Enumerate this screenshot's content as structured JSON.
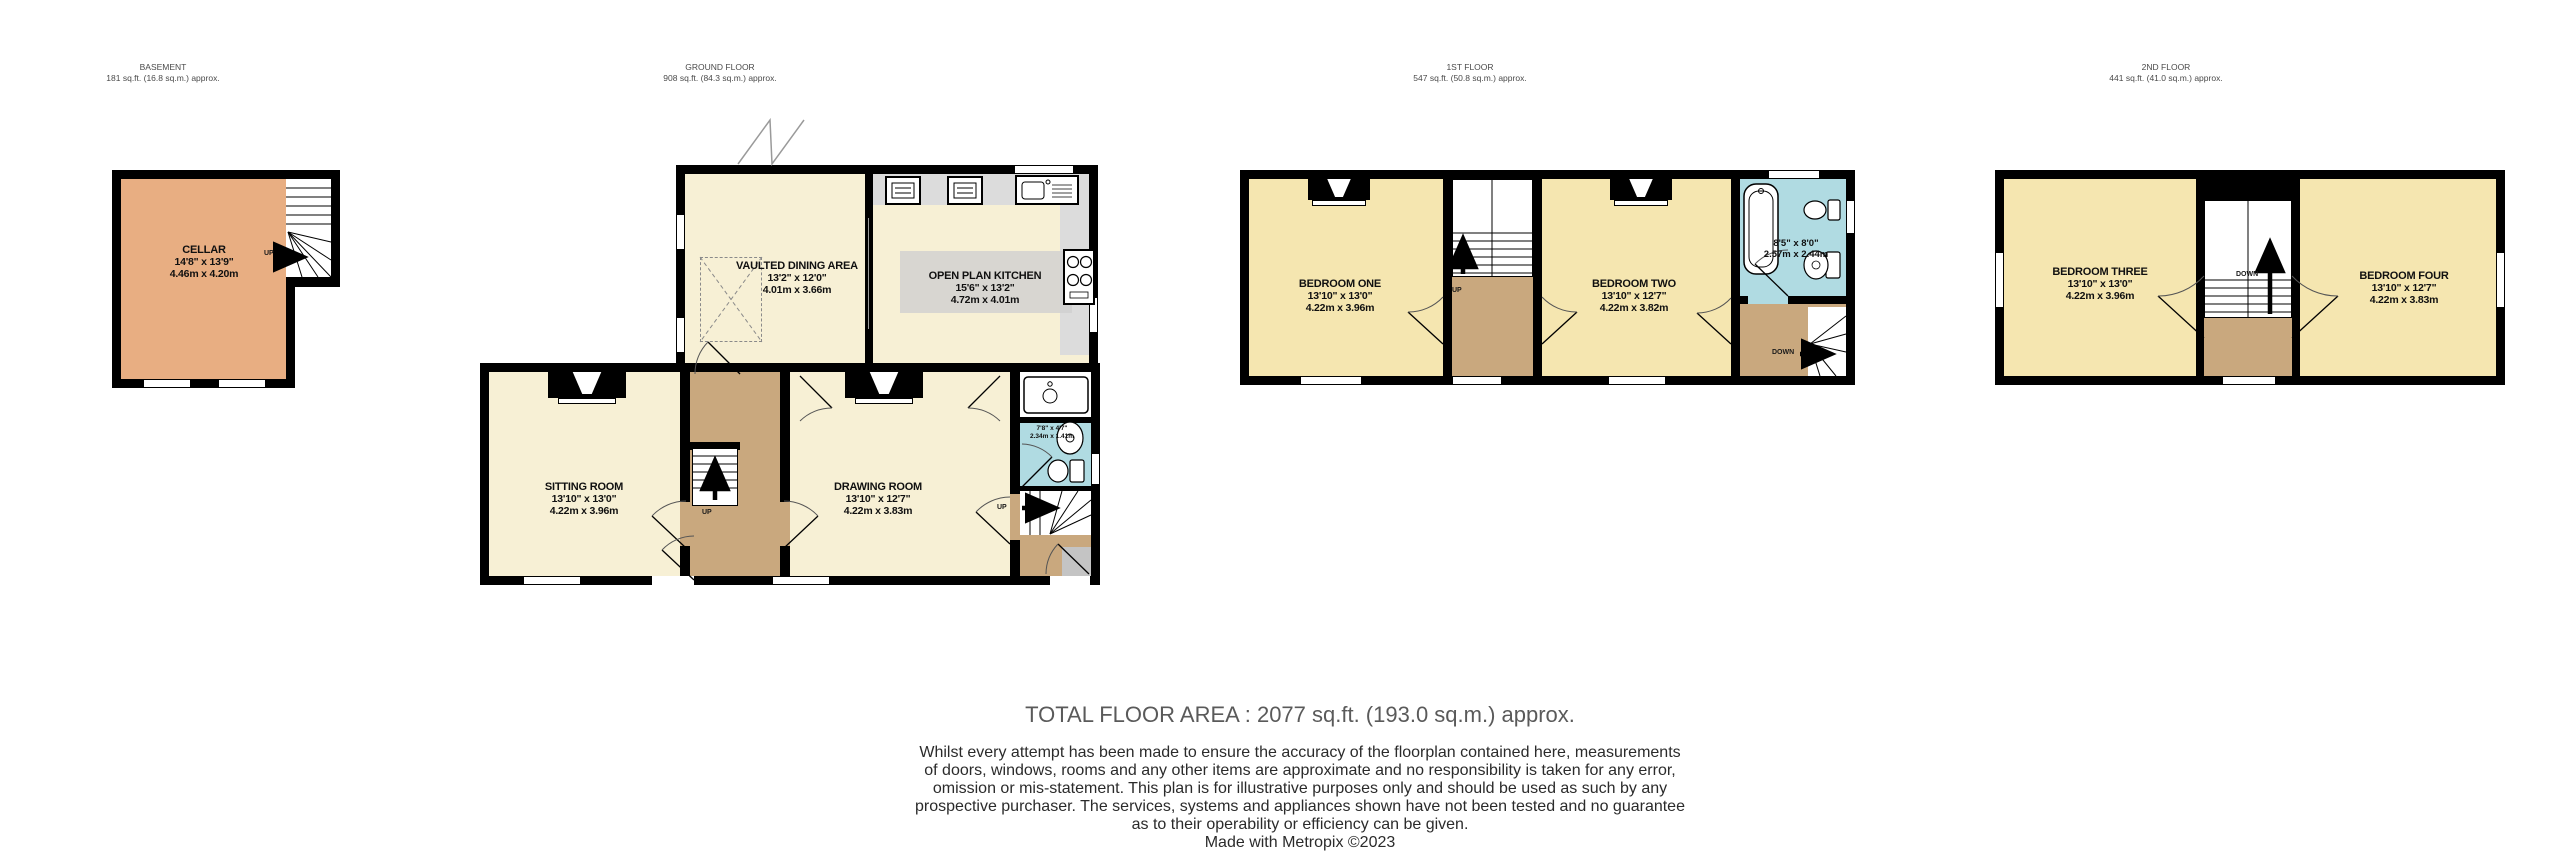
{
  "document_type": "Property Floorplan",
  "floors": {
    "basement": {
      "label": "BASEMENT",
      "area": "181 sq.ft. (16.8 sq.m.) approx."
    },
    "ground": {
      "label": "GROUND FLOOR",
      "area": "908 sq.ft. (84.3 sq.m.) approx."
    },
    "first": {
      "label": "1ST FLOOR",
      "area": "547 sq.ft. (50.8 sq.m.) approx."
    },
    "second": {
      "label": "2ND FLOOR",
      "area": "441 sq.ft. (41.0 sq.m.) approx."
    }
  },
  "rooms": {
    "cellar": {
      "name": "CELLAR",
      "imperial": "14'8\" x 13'9\"",
      "metric": "4.46m x 4.20m"
    },
    "dining": {
      "name": "VAULTED DINING AREA",
      "imperial": "13'2\" x 12'0\"",
      "metric": "4.01m x 3.66m"
    },
    "kitchen": {
      "name": "OPEN PLAN KITCHEN",
      "imperial": "15'6\" x 13'2\"",
      "metric": "4.72m x 4.01m"
    },
    "sitting": {
      "name": "SITTING ROOM",
      "imperial": "13'10\" x 13'0\"",
      "metric": "4.22m x 3.96m"
    },
    "drawing": {
      "name": "DRAWING ROOM",
      "imperial": "13'10\" x 12'7\"",
      "metric": "4.22m x 3.83m"
    },
    "shower": {
      "name": "",
      "imperial": "7'8\" x 4'7\"",
      "metric": "2.34m x 1.41m"
    },
    "bed1": {
      "name": "BEDROOM ONE",
      "imperial": "13'10\" x 13'0\"",
      "metric": "4.22m x 3.96m"
    },
    "bed2": {
      "name": "BEDROOM TWO",
      "imperial": "13'10\" x 12'7\"",
      "metric": "4.22m x 3.82m"
    },
    "bath": {
      "name": "",
      "imperial": "8'5\" x 8'0\"",
      "metric": "2.57m x 2.44m"
    },
    "bed3": {
      "name": "BEDROOM THREE",
      "imperial": "13'10\" x 13'0\"",
      "metric": "4.22m x 3.96m"
    },
    "bed4": {
      "name": "BEDROOM FOUR",
      "imperial": "13'10\" x 12'7\"",
      "metric": "4.22m x 3.83m"
    }
  },
  "stairs": {
    "up": "UP",
    "down": "DOWN"
  },
  "footer": {
    "total": "TOTAL FLOOR AREA : 2077 sq.ft. (193.0 sq.m.) approx.",
    "disclaimer": [
      "Whilst every attempt has been made to ensure the accuracy of the floorplan contained here, measurements",
      "of doors, windows, rooms and any other items are approximate and no responsibility is taken for any error,",
      "omission or mis-statement. This plan is for illustrative purposes only and should be used as such by any",
      "prospective purchaser. The services, systems and appliances shown have not been tested and no guarantee",
      "as to their operability or efficiency can be given.",
      "Made with Metropix ©2023"
    ]
  },
  "colors": {
    "wall": "#000000",
    "cream_room": "#f7f0d5",
    "yellow_room": "#f5e6b0",
    "cellar": "#e8ae82",
    "hall": "#c9a87e",
    "bathroom": "#b0dbe2",
    "counter": "#dcdcdc"
  }
}
